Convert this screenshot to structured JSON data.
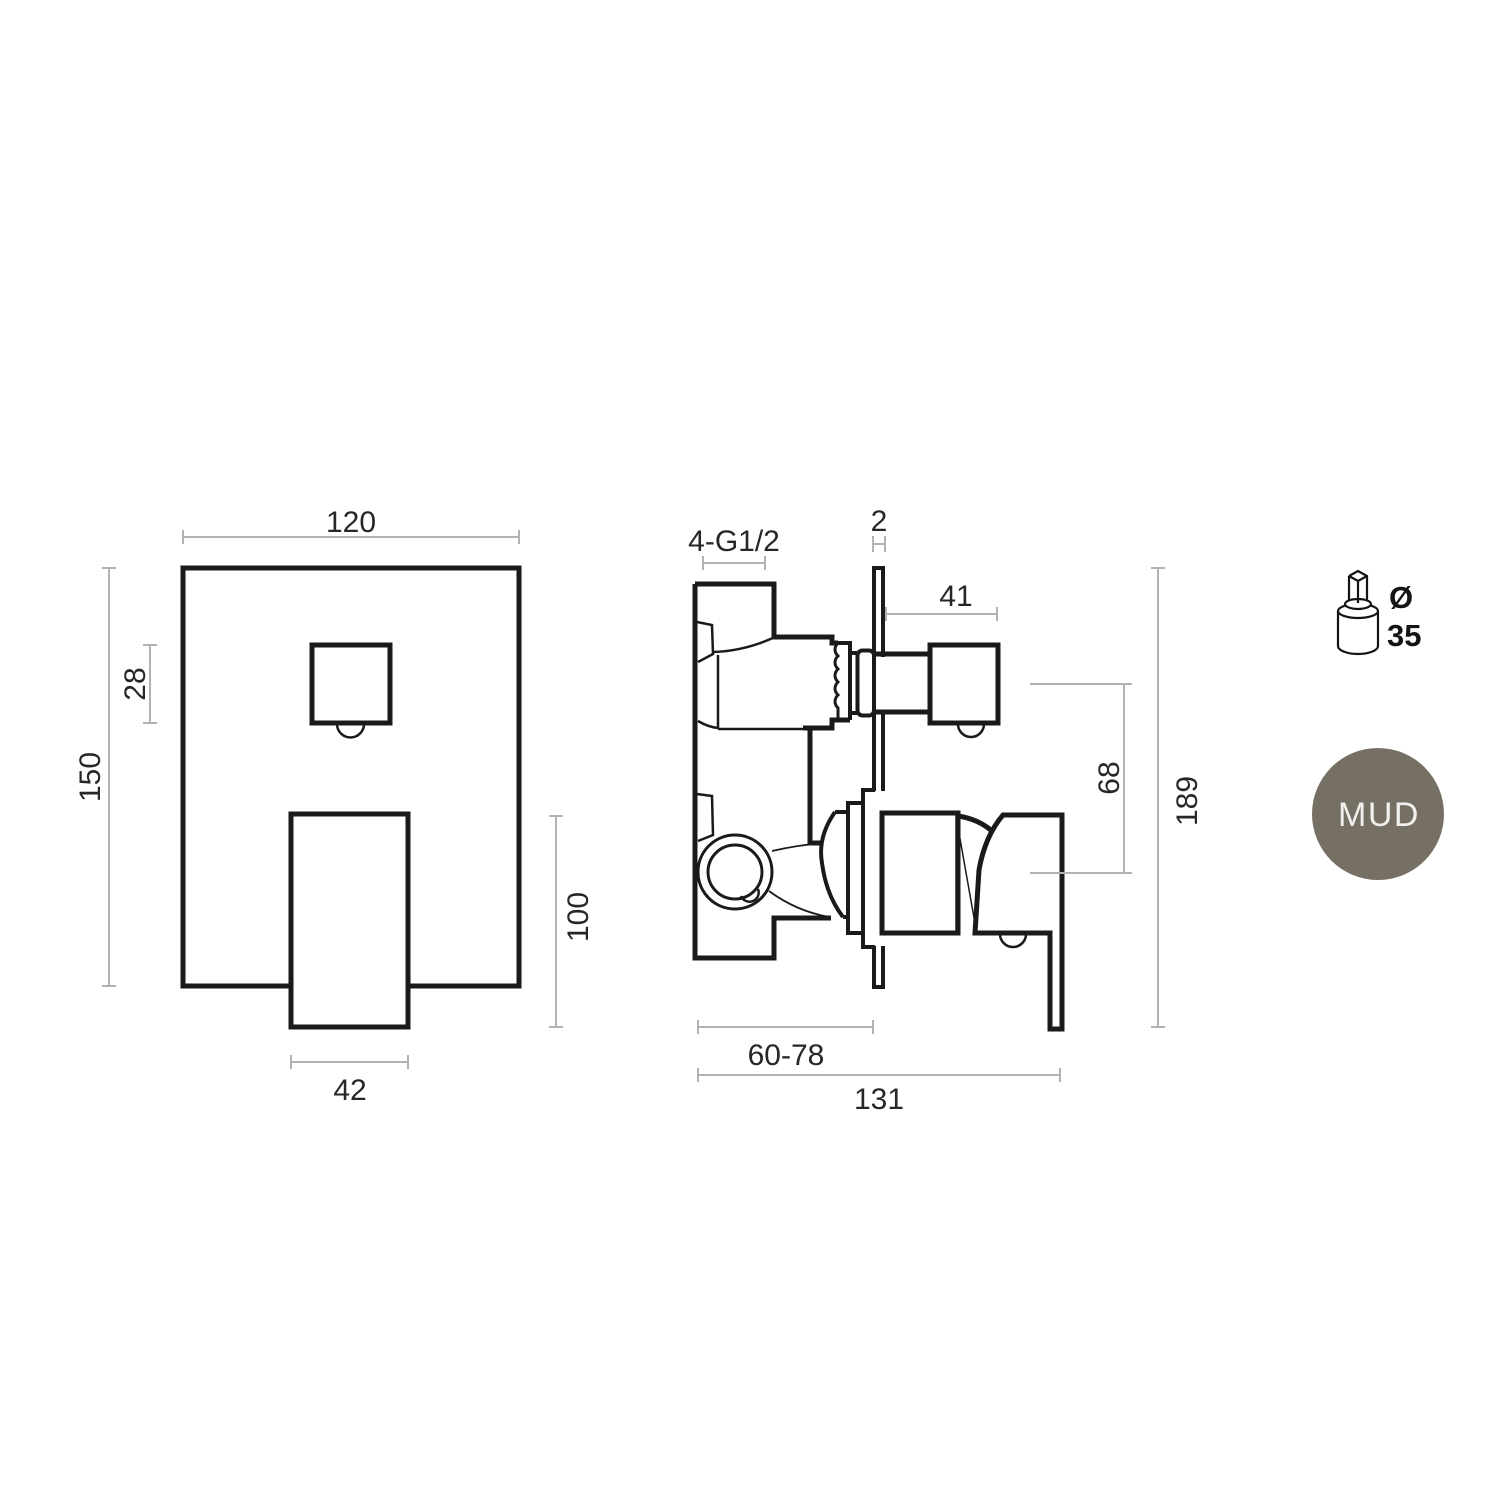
{
  "front_view": {
    "dim_width": "120",
    "dim_height": "150",
    "dim_button_size": "28",
    "dim_handle_width": "42",
    "dim_handle_length": "100"
  },
  "side_view": {
    "dim_ports": "4-G1/2",
    "dim_plate_thickness": "2",
    "dim_knob_depth": "41",
    "dim_axis_distance": "68",
    "dim_total_height": "189",
    "dim_recess_depth": "60-78",
    "dim_total_depth": "131"
  },
  "cartridge_icon": {
    "diameter_symbol": "Ø",
    "diameter_value": "35"
  },
  "finish_badge": {
    "label": "MUD"
  },
  "colors": {
    "line": "#1a1a1a",
    "dimension_line": "#b2b2b2",
    "dimension_text": "#26262b",
    "badge_fill": "#757063",
    "badge_text": "#f1f0ed",
    "background": "#ffffff"
  }
}
